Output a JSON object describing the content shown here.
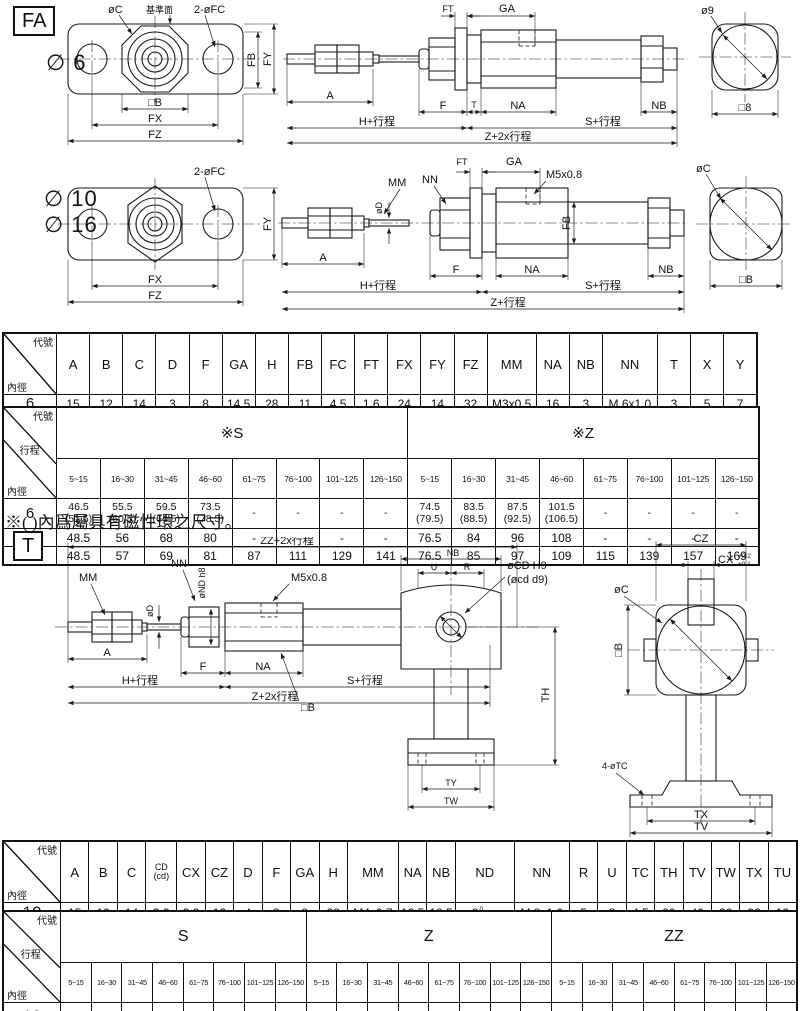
{
  "fa": {
    "badge": "FA",
    "bore6": "∅ 6",
    "bore10": "∅ 10",
    "bore16": "∅ 16",
    "front6": {
      "oc": "øC",
      "datum": "基準面",
      "fc": "2-øFC",
      "fb": "FB",
      "fy": "FY",
      "b": "□B",
      "fx": "FX",
      "fz": "FZ"
    },
    "side6": {
      "ft": "FT",
      "ga": "GA",
      "a": "A",
      "f": "F",
      "t": "T",
      "na": "NA",
      "nb": "NB",
      "h": "H+行程",
      "s": "S+行程",
      "z": "Z+2x行程"
    },
    "end6": {
      "d": "ø9",
      "b": "□8"
    },
    "front1016": {
      "fc": "2-øFC",
      "fy": "FY",
      "fx": "FX",
      "fz": "FZ"
    },
    "side1016": {
      "mm": "MM",
      "od": "øD",
      "nn": "NN",
      "ft": "FT",
      "ga": "GA",
      "m5": "M5x0.8",
      "fb": "FB",
      "a": "A",
      "f": "F",
      "na": "NA",
      "nb": "NB",
      "h": "H+行程",
      "s": "S+行程",
      "z": "Z+行程"
    },
    "end1016": {
      "c": "øC",
      "b": "□B"
    }
  },
  "note": "※( )內爲屬具有磁性環之尺寸。",
  "t": {
    "badge": "T",
    "side": {
      "zz": "ZZ+2x行程",
      "mm": "MM",
      "od": "øD",
      "nn": "NN",
      "ond": "øND h8",
      "ga": "GA",
      "m5": "M5x0.8",
      "nb": "NB",
      "u": "U",
      "r": "R",
      "ocd": "øCD H9",
      "ocd2": "(øcd d9)",
      "b": "□B",
      "a": "A",
      "f": "F",
      "na": "NA",
      "h": "H+行程",
      "s": "S+行程",
      "z": "Z+2x行程",
      "th": "TH",
      "ty": "TY",
      "tw": "TW"
    },
    "front": {
      "cz": "CZ",
      "cx": "CX",
      "cx_sup": "+0.2",
      "cx_sub": "+0.1",
      "oc": "øC",
      "b": "□B",
      "tc": "4-øTC",
      "tx": "TX",
      "tv": "TV"
    }
  },
  "tables": {
    "t_fa_dim": {
      "corner_top": "代號",
      "corner_bottom": "內徑",
      "headers": [
        "A",
        "B",
        "C",
        "D",
        "F",
        "GA",
        "H",
        "FB",
        "FC",
        "FT",
        "FX",
        "FY",
        "FZ",
        "MM",
        "NA",
        "NB",
        "NN",
        "T",
        "X",
        "Y"
      ],
      "rows": [
        {
          "bore": "6",
          "cells": [
            "15",
            "12",
            "14",
            "3",
            "8",
            "14.5",
            "28",
            "11",
            "4.5",
            "1.6",
            "24",
            "14",
            "32",
            "M3x0.5",
            "16",
            "3",
            "M 6x1.0",
            "3",
            "5",
            "7"
          ]
        },
        {
          "bore": "10",
          "cells": [
            "15",
            "12",
            "14",
            "4",
            "8",
            "8",
            "28",
            "13",
            "4.5",
            "1.6",
            "24",
            "14",
            "32",
            "M4x0.7",
            "12.5",
            "5.5",
            "M 8x1.0",
            "-",
            "5",
            "7"
          ]
        },
        {
          "bore": "16",
          "cells": [
            "15",
            "18",
            "20",
            "5",
            "8",
            "8",
            "28",
            "19",
            "5.5",
            "2.3",
            "33",
            "20",
            "42",
            "M5x0.8",
            "12.5",
            "5.5",
            "M10x1.0",
            "-",
            "6",
            "9"
          ]
        }
      ]
    },
    "t_fa_stroke": {
      "corner": [
        "代號",
        "行程",
        "內徑"
      ],
      "groups": [
        "※S",
        "※Z"
      ],
      "stroke_cols": [
        "5~15",
        "16~30",
        "31~45",
        "46~60",
        "61~75",
        "76~100",
        "101~125",
        "126~150",
        "5~15",
        "16~30",
        "31~45",
        "46~60",
        "61~75",
        "76~100",
        "101~125",
        "126~150"
      ],
      "rows": [
        {
          "bore": "6",
          "cells": [
            "46.5\n(51.5)",
            "55.5\n(60.5)",
            "59.5\n(64.5)",
            "73.5\n(78.5)",
            "-",
            "-",
            "-",
            "-",
            "74.5\n(79.5)",
            "83.5\n(88.5)",
            "87.5\n(92.5)",
            "101.5\n(106.5)",
            "-",
            "-",
            "-",
            "-"
          ]
        },
        {
          "bore": "10",
          "cells": [
            "48.5",
            "56",
            "68",
            "80",
            "-",
            "-",
            "-",
            "-",
            "76.5",
            "84",
            "96",
            "108",
            "-",
            "-",
            "-",
            "-"
          ]
        },
        {
          "bore": "16",
          "cells": [
            "48.5",
            "57",
            "69",
            "81",
            "87",
            "111",
            "129",
            "141",
            "76.5",
            "85",
            "97",
            "109",
            "115",
            "139",
            "157",
            "169"
          ]
        }
      ]
    },
    "t_t_dim": {
      "corner_top": "代號",
      "corner_bottom": "內徑",
      "headers": [
        "A",
        "B",
        "C",
        "CD\n(cd)",
        "CX",
        "CZ",
        "D",
        "F",
        "GA",
        "H",
        "MM",
        "NA",
        "NB",
        "ND",
        "NN",
        "R",
        "U",
        "TC",
        "TH",
        "TV",
        "TW",
        "TX",
        "TU"
      ],
      "rows": [
        {
          "bore": "10",
          "cells": [
            "15",
            "12",
            "14",
            "3.3",
            "3.2",
            "12",
            "4",
            "8",
            "8",
            "28",
            "M4x0.7",
            "12.5",
            "18.5",
            {
              "base": "8",
              "sup": "0",
              "sub": "-0.022"
            },
            "M 8x1.0",
            "5",
            "8",
            "4.5",
            "29",
            "40",
            "22",
            "32",
            "12"
          ]
        },
        {
          "bore": "16",
          "cells": [
            "15",
            "18",
            "20",
            "5",
            "6.5",
            "18",
            "5",
            "8",
            "8",
            "28",
            "M5x0.8",
            "12.5",
            "23.5",
            {
              "base": "10",
              "sup": "0",
              "sub": "-0.022"
            },
            "M10x1.0",
            "8",
            "10",
            "5.5",
            "35",
            "48",
            "28",
            "38",
            "16"
          ]
        }
      ]
    },
    "t_t_stroke": {
      "corner": [
        "代號",
        "行程",
        "內徑"
      ],
      "groups": [
        "S",
        "Z",
        "ZZ"
      ],
      "stroke_cols": [
        "5~15",
        "16~30",
        "31~45",
        "46~60",
        "61~75",
        "76~100",
        "101~125",
        "126~150",
        "5~15",
        "16~30",
        "31~45",
        "46~60",
        "61~75",
        "76~100",
        "101~125",
        "126~150",
        "5~15",
        "16~30",
        "31~45",
        "46~60",
        "61~75",
        "76~100",
        "101~125",
        "126~150"
      ],
      "rows": [
        {
          "bore": "10",
          "cells": [
            "48.5",
            "56",
            "68",
            "80",
            "-",
            "-",
            "-",
            "-",
            "84.5",
            "92",
            "104",
            "116",
            "-",
            "-",
            "-",
            "-",
            "95.5",
            "103",
            "115",
            "127",
            "-",
            "-",
            "-",
            "-"
          ]
        },
        {
          "bore": "16",
          "cells": [
            "48.5",
            "57",
            "69",
            "81",
            "87",
            "111",
            "129",
            "141",
            "86.5",
            "95",
            "107",
            "119",
            "125",
            "149",
            "167",
            "179",
            "100.5",
            "109",
            "121",
            "133",
            "139",
            "163",
            "181",
            "193"
          ]
        }
      ]
    }
  }
}
